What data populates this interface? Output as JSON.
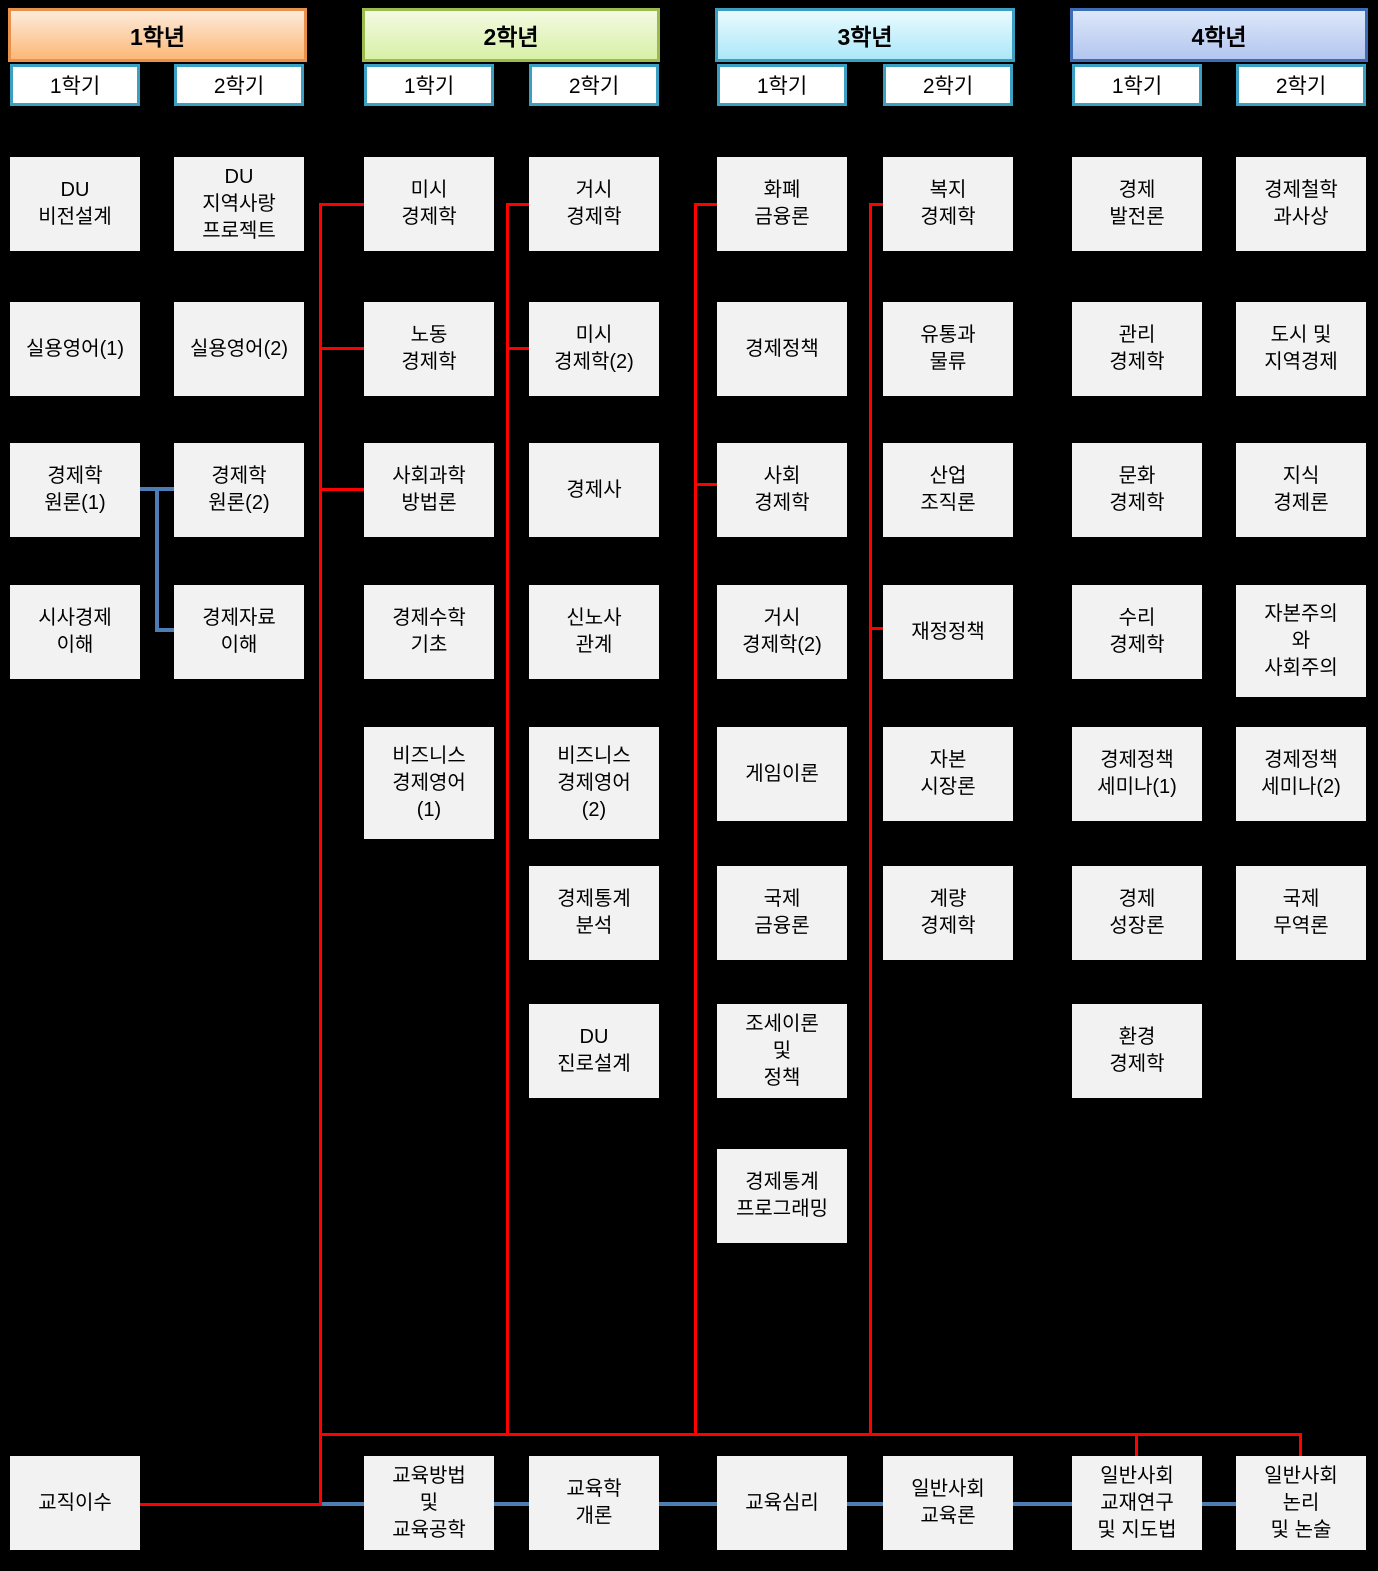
{
  "colors": {
    "background": "#000000",
    "course_box_fill": "#F2F2F2",
    "course_box_text": "#000000",
    "semester_tab_fill": "#FFFFFF",
    "semester_tab_border": "#3A9FC1",
    "red_connector": "#FE0000",
    "blue_connector": "#4E7DB5"
  },
  "years": [
    {
      "label": "1학년",
      "header_colors": {
        "top": "#FDEBDB",
        "bottom": "#FBB877",
        "border": "#E8914C"
      },
      "semesters": [
        {
          "label": "1학기",
          "courses": [
            {
              "title": "DU\n비전설계",
              "row": 0
            },
            {
              "title": "실용영어(1)",
              "row": 1
            },
            {
              "title": "경제학\n원론(1)",
              "row": 2
            },
            {
              "title": "시사경제\n이해",
              "row": 3
            }
          ]
        },
        {
          "label": "2학기",
          "courses": [
            {
              "title": "DU\n지역사랑\n프로젝트",
              "row": 0
            },
            {
              "title": "실용영어(2)",
              "row": 1
            },
            {
              "title": "경제학\n원론(2)",
              "row": 2
            },
            {
              "title": "경제자료\n이해",
              "row": 3
            }
          ]
        }
      ]
    },
    {
      "label": "2학년",
      "header_colors": {
        "top": "#F3FAE3",
        "bottom": "#D8F0A6",
        "border": "#9CBB4F"
      },
      "semesters": [
        {
          "label": "1학기",
          "courses": [
            {
              "title": "미시\n경제학",
              "row": 0
            },
            {
              "title": "노동\n경제학",
              "row": 1
            },
            {
              "title": "사회과학\n방법론",
              "row": 2
            },
            {
              "title": "경제수학\n기초",
              "row": 3
            },
            {
              "title": "비즈니스\n경제영어\n(1)",
              "row": 4,
              "tall": true
            }
          ]
        },
        {
          "label": "2학기",
          "courses": [
            {
              "title": "거시\n경제학",
              "row": 0
            },
            {
              "title": "미시\n경제학(2)",
              "row": 1
            },
            {
              "title": "경제사",
              "row": 2
            },
            {
              "title": "신노사\n관계",
              "row": 3
            },
            {
              "title": "비즈니스\n경제영어\n(2)",
              "row": 4,
              "tall": true
            },
            {
              "title": "경제통계\n분석",
              "row": 5
            },
            {
              "title": "DU\n진로설계",
              "row": 6
            }
          ]
        }
      ]
    },
    {
      "label": "3학년",
      "header_colors": {
        "top": "#EAFAFE",
        "bottom": "#ACE8F8",
        "border": "#3A9FC1"
      },
      "semesters": [
        {
          "label": "1학기",
          "courses": [
            {
              "title": "화폐\n금융론",
              "row": 0
            },
            {
              "title": "경제정책",
              "row": 1
            },
            {
              "title": "사회\n경제학",
              "row": 2
            },
            {
              "title": "거시\n경제학(2)",
              "row": 3
            },
            {
              "title": "게임이론",
              "row": 4
            },
            {
              "title": "국제\n금융론",
              "row": 5
            },
            {
              "title": "조세이론\n및\n정책",
              "row": 6
            },
            {
              "title": "경제통계\n프로그래밍",
              "row": 7
            }
          ]
        },
        {
          "label": "2학기",
          "courses": [
            {
              "title": "복지\n경제학",
              "row": 0
            },
            {
              "title": "유통과\n물류",
              "row": 1
            },
            {
              "title": "산업\n조직론",
              "row": 2
            },
            {
              "title": "재정정책",
              "row": 3
            },
            {
              "title": "자본\n시장론",
              "row": 4
            },
            {
              "title": "계량\n경제학",
              "row": 5
            }
          ]
        }
      ]
    },
    {
      "label": "4학년",
      "header_colors": {
        "top": "#DDE7F9",
        "bottom": "#B3C6EF",
        "border": "#3D6EB5"
      },
      "semesters": [
        {
          "label": "1학기",
          "courses": [
            {
              "title": "경제\n발전론",
              "row": 0
            },
            {
              "title": "관리\n경제학",
              "row": 1
            },
            {
              "title": "문화\n경제학",
              "row": 2
            },
            {
              "title": "수리\n경제학",
              "row": 3
            },
            {
              "title": "경제정책\n세미나(1)",
              "row": 4
            },
            {
              "title": "경제\n성장론",
              "row": 5
            },
            {
              "title": "환경\n경제학",
              "row": 6
            }
          ]
        },
        {
          "label": "2학기",
          "courses": [
            {
              "title": "경제철학\n과사상",
              "row": 0
            },
            {
              "title": "도시 및\n지역경제",
              "row": 1
            },
            {
              "title": "지식\n경제론",
              "row": 2
            },
            {
              "title": "자본주의\n와\n사회주의",
              "row": 3,
              "tall": true
            },
            {
              "title": "경제정책\n세미나(2)",
              "row": 4
            },
            {
              "title": "국제\n무역론",
              "row": 5
            }
          ]
        }
      ]
    }
  ],
  "teacher_track": [
    {
      "title": "교직이수",
      "col": 0
    },
    {
      "title": "교육방법\n및\n교육공학",
      "col": 2
    },
    {
      "title": "교육학\n개론",
      "col": 3
    },
    {
      "title": "교육심리",
      "col": 4
    },
    {
      "title": "일반사회\n교육론",
      "col": 5
    },
    {
      "title": "일반사회\n교재연구\n및 지도법",
      "col": 6
    },
    {
      "title": "일반사회\n논리\n및 논술",
      "col": 7
    }
  ]
}
